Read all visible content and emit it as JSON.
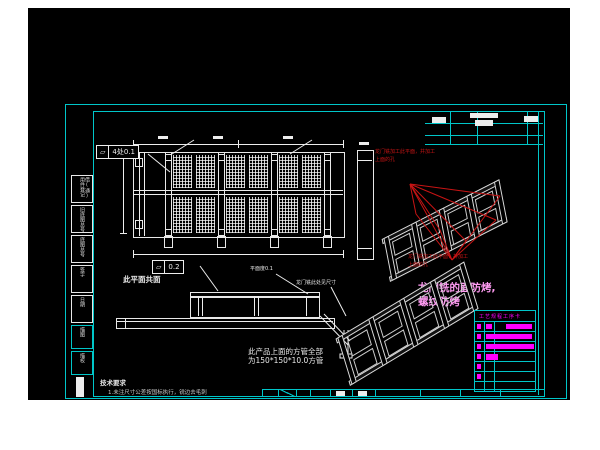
{
  "drawing": {
    "callout_flatness_top": {
      "symbol": "⏥",
      "value": "4处0.1"
    },
    "callout_flatness_mid": {
      "symbol": "⏥",
      "value": "0.2"
    },
    "note_coplanar": "此平面共面",
    "note_flatness": "平面度0.1",
    "note_gantry_dim": "龙门铣此处见尺寸",
    "note_square_tube_1": "此产品上面的方管全部",
    "note_square_tube_2": "为150*150*10.0方管",
    "red_note_top_line1": "龙门铣加工此平面，并加工",
    "red_note_top_line2": "上面的孔",
    "red_note_bottom_line1": "龙门铣加工此平面，并加工",
    "red_note_bottom_line2": "上面的孔",
    "magenta_note_line1": "龙门铣的面防烤,",
    "magenta_note_line2": "螺纹防烤",
    "tech_req_title": "技术要求",
    "tech_req_item": "1.未注尺寸公差按国标执行，锐边去毛刺"
  },
  "border": {
    "left_cells": [
      {
        "label": "借(通)用件登记"
      },
      {
        "label": "旧底图总号"
      },
      {
        "label": "底图总号"
      },
      {
        "label": "签字"
      },
      {
        "label": "日期"
      },
      {
        "label": "描图"
      },
      {
        "label": "描校"
      }
    ],
    "title_table": {
      "header": "工艺规程工序卡"
    }
  },
  "colors": {
    "frame_cyan": "#00c6c9",
    "line_white": "#ededed",
    "annotation_red": "#c81414",
    "note_magenta": "#ff9bf2",
    "table_magenta": "#ff00ff",
    "background": "#000000"
  }
}
